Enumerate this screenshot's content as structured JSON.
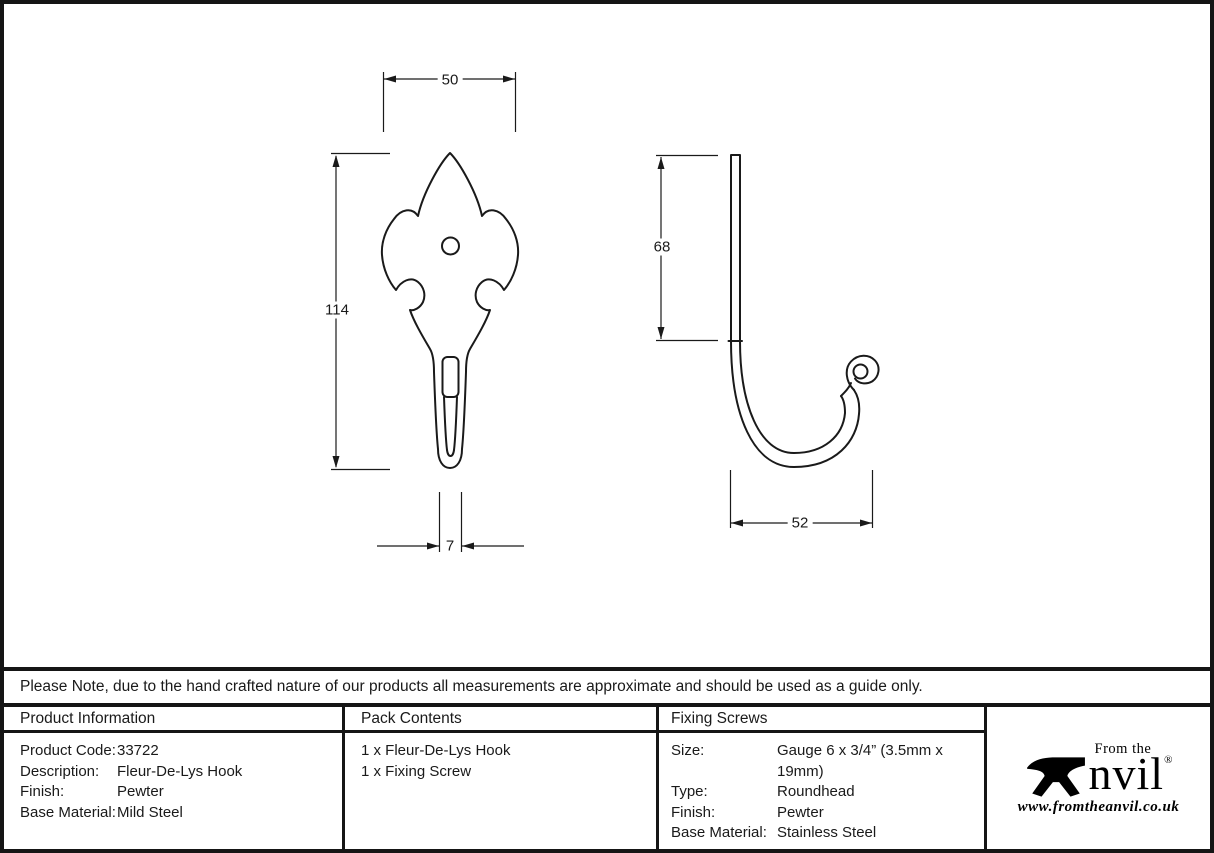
{
  "note": "Please Note, due to the hand crafted nature of our products all measurements are approximate and should be used as a guide only.",
  "drawing": {
    "front_view": {
      "width_label": "50",
      "height_label": "114",
      "stem_width_label": "7"
    },
    "side_view": {
      "shank_length_label": "68",
      "projection_label": "52"
    }
  },
  "table": {
    "product_information": {
      "header": "Product Information",
      "rows": [
        {
          "label": "Product Code:",
          "value": "33722"
        },
        {
          "label": "Description:",
          "value": "Fleur-De-Lys Hook"
        },
        {
          "label": "Finish:",
          "value": "Pewter"
        },
        {
          "label": "Base Material:",
          "value": "Mild Steel"
        }
      ]
    },
    "pack_contents": {
      "header": "Pack Contents",
      "items": [
        "1 x Fleur-De-Lys Hook",
        "1 x Fixing Screw"
      ]
    },
    "fixing_screws": {
      "header": "Fixing Screws",
      "rows": [
        {
          "label": "Size:",
          "value": "Gauge 6 x 3/4” (3.5mm x 19mm)"
        },
        {
          "label": "Type:",
          "value": "Roundhead"
        },
        {
          "label": "Finish:",
          "value": "Pewter"
        },
        {
          "label": "Base Material:",
          "value": "Stainless Steel"
        }
      ]
    }
  },
  "logo": {
    "brand_top": "From the",
    "brand_main": "Anvil",
    "brand_main_tail": "nvil",
    "registered": "®",
    "website": "www.fromtheanvil.co.uk"
  },
  "colors": {
    "line": "#1a1a1a",
    "border": "#151515",
    "background": "#ffffff"
  }
}
